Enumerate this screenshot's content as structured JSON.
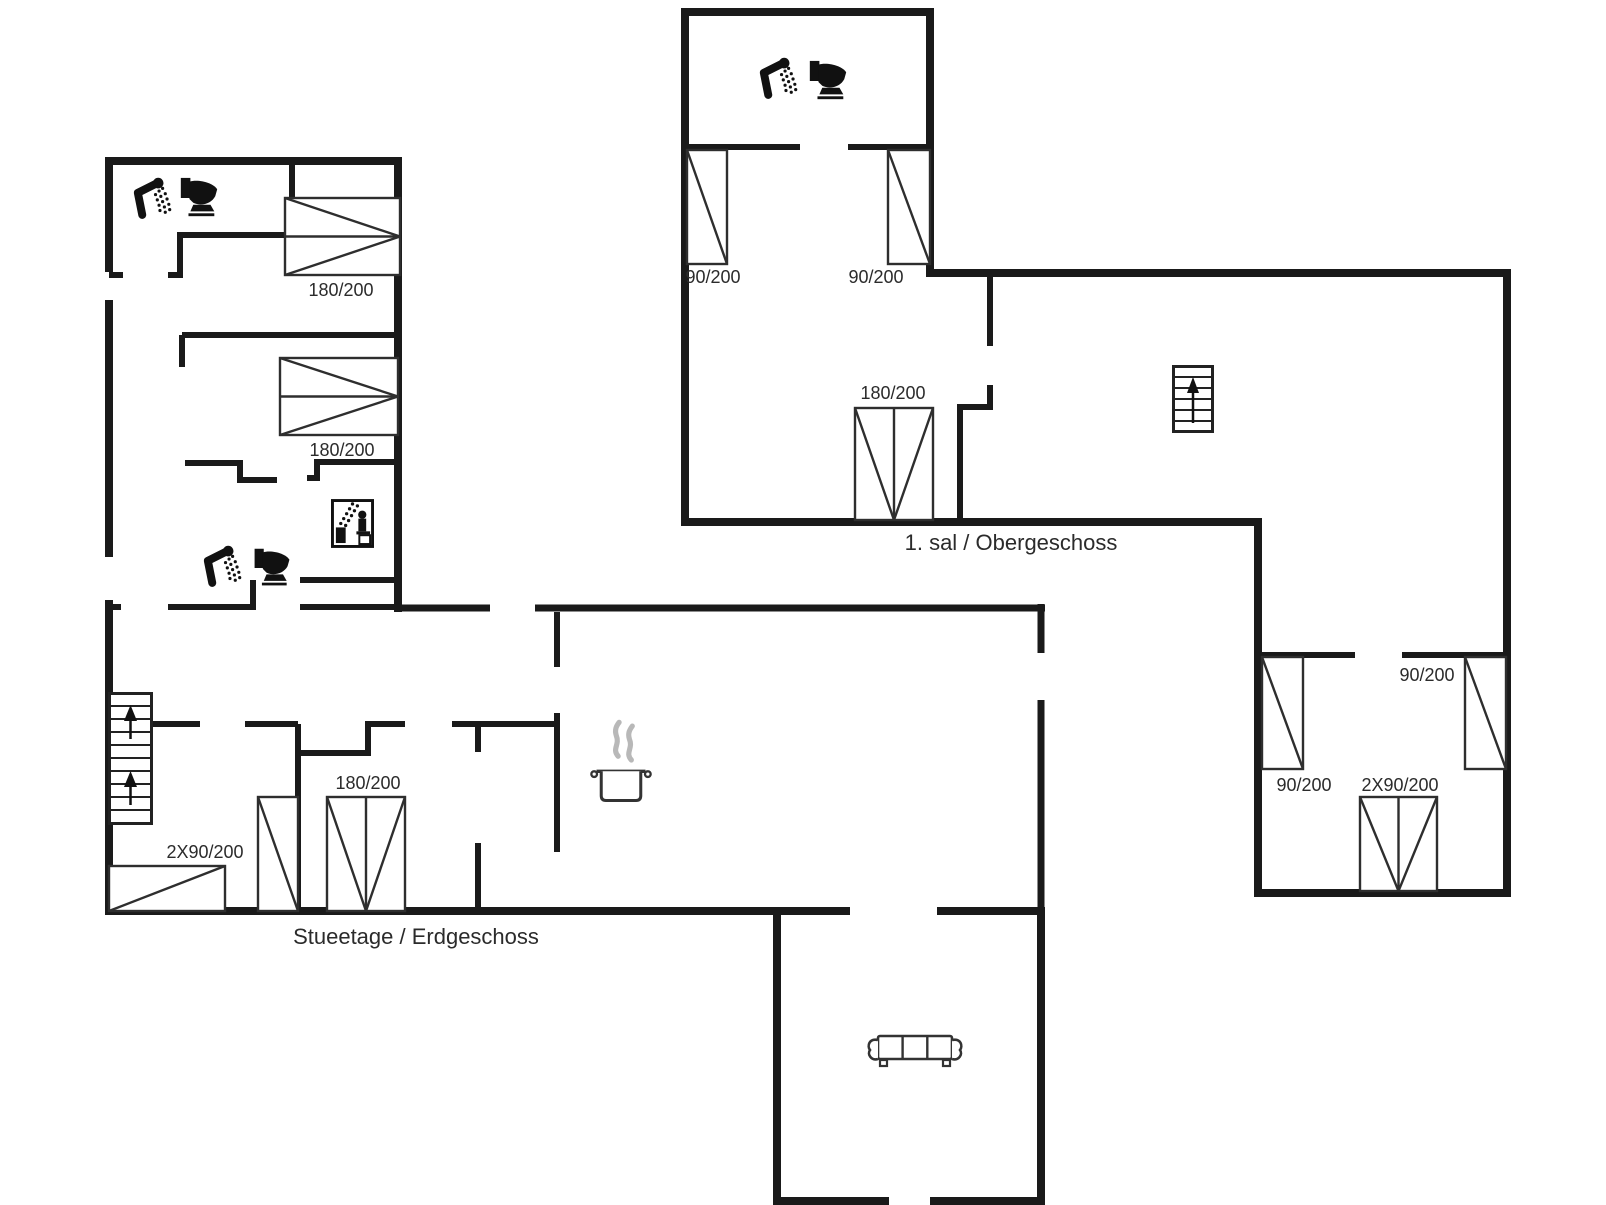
{
  "document_type": "floor-plan",
  "colors": {
    "background": "#ffffff",
    "wall": "#1a1a1a",
    "thin_line": "#2e2e2e",
    "text": "#2b2b2b",
    "steam": "#b8b8b8"
  },
  "floors": [
    {
      "id": "ground-floor",
      "name": "Stueetage / Erdgeschoss",
      "walls": [
        [
          105,
          161,
          402,
          161,
          8
        ],
        [
          398,
          157,
          398,
          612,
          8
        ],
        [
          109,
          157,
          109,
          272,
          8
        ],
        [
          109,
          300,
          109,
          557,
          8
        ],
        [
          109,
          600,
          109,
          915,
          8
        ],
        [
          398,
          608,
          490,
          608,
          7
        ],
        [
          535,
          608,
          1045,
          608,
          7
        ],
        [
          1041,
          604,
          1041,
          653,
          7
        ],
        [
          1041,
          700,
          1041,
          915,
          7
        ],
        [
          105,
          911,
          850,
          911,
          8
        ],
        [
          937,
          911,
          1045,
          911,
          8
        ],
        [
          777,
          907,
          777,
          1205,
          8
        ],
        [
          1041,
          907,
          1041,
          1205,
          8
        ],
        [
          777,
          1201,
          889,
          1201,
          8
        ],
        [
          930,
          1201,
          1045,
          1201,
          8
        ],
        [
          109,
          275,
          123,
          275,
          6
        ],
        [
          168,
          275,
          180,
          275,
          6
        ],
        [
          180,
          235,
          180,
          278,
          6
        ],
        [
          177,
          235,
          292,
          235,
          6
        ],
        [
          292,
          161,
          292,
          238,
          6
        ],
        [
          182,
          335,
          398,
          335,
          6
        ],
        [
          182,
          335,
          182,
          367,
          6
        ],
        [
          185,
          463,
          243,
          463,
          6
        ],
        [
          240,
          463,
          240,
          483,
          6
        ],
        [
          240,
          480,
          277,
          480,
          6
        ],
        [
          307,
          478,
          320,
          478,
          6
        ],
        [
          317,
          462,
          317,
          481,
          6
        ],
        [
          314,
          462,
          398,
          462,
          6
        ],
        [
          300,
          580,
          398,
          580,
          6
        ],
        [
          253,
          580,
          253,
          610,
          6
        ],
        [
          109,
          607,
          121,
          607,
          6
        ],
        [
          168,
          607,
          253,
          607,
          6
        ],
        [
          300,
          607,
          398,
          607,
          6
        ],
        [
          152,
          724,
          200,
          724,
          6
        ],
        [
          245,
          724,
          298,
          724,
          6
        ],
        [
          298,
          724,
          298,
          911,
          6
        ],
        [
          295,
          753,
          371,
          753,
          6
        ],
        [
          368,
          724,
          368,
          756,
          6
        ],
        [
          365,
          724,
          405,
          724,
          6
        ],
        [
          452,
          724,
          558,
          724,
          6
        ],
        [
          478,
          724,
          478,
          752,
          6
        ],
        [
          557,
          612,
          557,
          667,
          6
        ],
        [
          557,
          713,
          557,
          852,
          6
        ],
        [
          478,
          843,
          478,
          911,
          6
        ]
      ],
      "beds": [
        {
          "x": 285,
          "y": 198,
          "w": 115,
          "h": 77,
          "style": "double-h",
          "size": "180/200"
        },
        {
          "x": 280,
          "y": 358,
          "w": 118,
          "h": 77,
          "style": "double-h",
          "size": "180/200"
        },
        {
          "x": 109,
          "y": 866,
          "w": 116,
          "h": 45,
          "style": "flat",
          "size": "2X90/200"
        },
        {
          "x": 258,
          "y": 797,
          "w": 40,
          "h": 114,
          "style": "single",
          "size": ""
        },
        {
          "x": 327,
          "y": 797,
          "w": 78,
          "h": 114,
          "style": "double-v",
          "size": "180/200"
        }
      ],
      "icons": [
        {
          "name": "shower-icon",
          "symbol": "shower",
          "x": 129,
          "y": 175,
          "w": 46,
          "h": 48
        },
        {
          "name": "toilet-icon",
          "symbol": "toilet",
          "x": 177,
          "y": 175,
          "w": 44,
          "h": 46
        },
        {
          "name": "shower-icon",
          "symbol": "shower",
          "x": 199,
          "y": 544,
          "w": 46,
          "h": 46
        },
        {
          "name": "toilet-icon",
          "symbol": "toilet",
          "x": 249,
          "y": 546,
          "w": 46,
          "h": 44
        },
        {
          "name": "sauna-icon",
          "symbol": "sauna",
          "x": 331,
          "y": 499,
          "w": 43,
          "h": 49
        },
        {
          "name": "staircase-icon",
          "symbol": "stairs2",
          "x": 108,
          "y": 692,
          "w": 45,
          "h": 133
        },
        {
          "name": "cooking-pot-icon",
          "symbol": "pot",
          "x": 589,
          "y": 718,
          "w": 64,
          "h": 84
        },
        {
          "name": "sofa-icon",
          "symbol": "sofa",
          "x": 865,
          "y": 1030,
          "w": 100,
          "h": 44
        }
      ],
      "labels": [
        {
          "text": "180/200",
          "x": 341,
          "y": 296,
          "size": 18,
          "kind": "dimension-label"
        },
        {
          "text": "180/200",
          "x": 342,
          "y": 456,
          "size": 18,
          "kind": "dimension-label"
        },
        {
          "text": "2X90/200",
          "x": 205,
          "y": 858,
          "size": 18,
          "kind": "dimension-label"
        },
        {
          "text": "180/200",
          "x": 368,
          "y": 789,
          "size": 18,
          "kind": "dimension-label"
        },
        {
          "text": "Stueetage / Erdgeschoss",
          "x": 416,
          "y": 944,
          "size": 22,
          "kind": "floor-label"
        }
      ]
    },
    {
      "id": "first-floor",
      "name": "1. sal / Obergeschoss",
      "walls": [
        [
          681,
          12,
          934,
          12,
          8
        ],
        [
          685,
          8,
          685,
          526,
          8
        ],
        [
          930,
          8,
          930,
          277,
          8
        ],
        [
          926,
          273,
          1511,
          273,
          8
        ],
        [
          1507,
          269,
          1507,
          897,
          8
        ],
        [
          681,
          522,
          1262,
          522,
          8
        ],
        [
          1258,
          518,
          1258,
          897,
          8
        ],
        [
          1254,
          893,
          1511,
          893,
          8
        ],
        [
          685,
          147,
          800,
          147,
          6
        ],
        [
          848,
          147,
          930,
          147,
          6
        ],
        [
          990,
          269,
          990,
          346,
          6
        ],
        [
          990,
          385,
          990,
          410,
          6
        ],
        [
          957,
          407,
          993,
          407,
          6
        ],
        [
          960,
          404,
          960,
          522,
          6
        ],
        [
          1258,
          655,
          1355,
          655,
          6
        ],
        [
          1402,
          655,
          1507,
          655,
          6
        ]
      ],
      "beds": [
        {
          "x": 687,
          "y": 150,
          "w": 40,
          "h": 114,
          "style": "single",
          "size": "90/200"
        },
        {
          "x": 888,
          "y": 150,
          "w": 42,
          "h": 114,
          "style": "single",
          "size": "90/200"
        },
        {
          "x": 855,
          "y": 408,
          "w": 78,
          "h": 112,
          "style": "double-v",
          "size": "180/200"
        },
        {
          "x": 1262,
          "y": 657,
          "w": 41,
          "h": 112,
          "style": "single",
          "size": "90/200"
        },
        {
          "x": 1465,
          "y": 657,
          "w": 41,
          "h": 112,
          "style": "single",
          "size": "90/200"
        },
        {
          "x": 1360,
          "y": 797,
          "w": 77,
          "h": 94,
          "style": "double-v",
          "size": "2X90/200"
        }
      ],
      "icons": [
        {
          "name": "shower-icon",
          "symbol": "shower",
          "x": 755,
          "y": 55,
          "w": 46,
          "h": 48
        },
        {
          "name": "toilet-icon",
          "symbol": "toilet",
          "x": 806,
          "y": 58,
          "w": 44,
          "h": 46
        },
        {
          "name": "staircase-icon",
          "symbol": "stairs1",
          "x": 1172,
          "y": 365,
          "w": 42,
          "h": 68
        }
      ],
      "labels": [
        {
          "text": "90/200",
          "x": 713,
          "y": 283,
          "size": 18,
          "kind": "dimension-label"
        },
        {
          "text": "90/200",
          "x": 876,
          "y": 283,
          "size": 18,
          "kind": "dimension-label"
        },
        {
          "text": "180/200",
          "x": 893,
          "y": 399,
          "size": 18,
          "kind": "dimension-label"
        },
        {
          "text": "90/200",
          "x": 1304,
          "y": 791,
          "size": 18,
          "kind": "dimension-label"
        },
        {
          "text": "90/200",
          "x": 1427,
          "y": 681,
          "size": 18,
          "kind": "dimension-label"
        },
        {
          "text": "2X90/200",
          "x": 1400,
          "y": 791,
          "size": 18,
          "kind": "dimension-label"
        },
        {
          "text": "1. sal / Obergeschoss",
          "x": 1011,
          "y": 550,
          "size": 22,
          "kind": "floor-label"
        }
      ]
    }
  ]
}
